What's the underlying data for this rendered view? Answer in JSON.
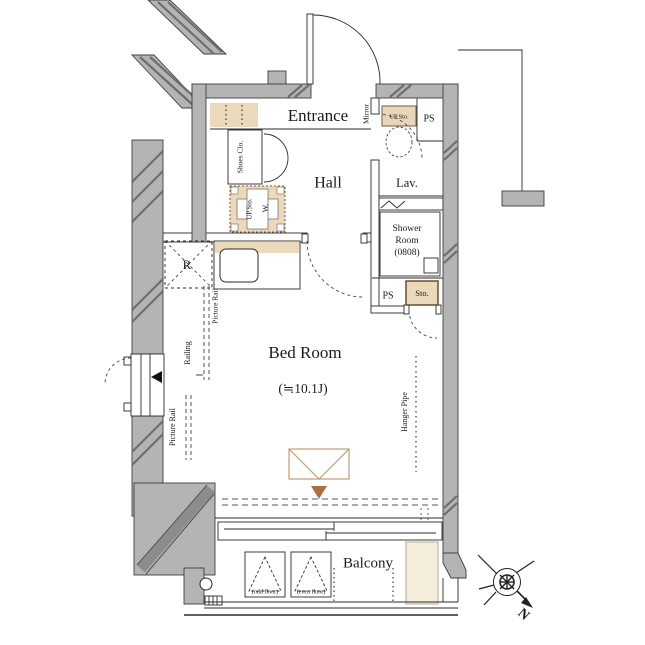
{
  "rooms": {
    "entrance": "Entrance",
    "hall": "Hall",
    "lav": "Lav.",
    "shower_line1": "Shower",
    "shower_line2": "Room",
    "shower_line3": "(0808)",
    "bedroom": "Bed Room",
    "bedroom_size": "(≒10.1J)",
    "balcony": "Balcony"
  },
  "fixtures": {
    "shoes_closet": "Shoes Clo.",
    "laundry_upper_storage": "UP.Sto.",
    "washer": "W.",
    "toilet_upper_storage": "UP.Sto.",
    "mirror": "Mirror",
    "storage": "Sto.",
    "refrigerator": "R",
    "hanger_pipe": "Hanger Pipe",
    "picture_rail_upper": "Picture Rail",
    "railing": "Railing",
    "picture_rail_lower": "Picture Rail",
    "odd_floor": "(odd floor)",
    "even_floor": "(even floor)"
  },
  "shafts": {
    "ps_top": "PS",
    "ps_mid": "PS"
  },
  "compass": {
    "north": "N"
  },
  "colors": {
    "wall": "#b4b4b4",
    "hatch": "#6e6e6e",
    "tan": "#ecd9bc",
    "accent_brown": "#ad6f3f",
    "panel": "#f6eedd",
    "line": "#2b2b2b"
  }
}
